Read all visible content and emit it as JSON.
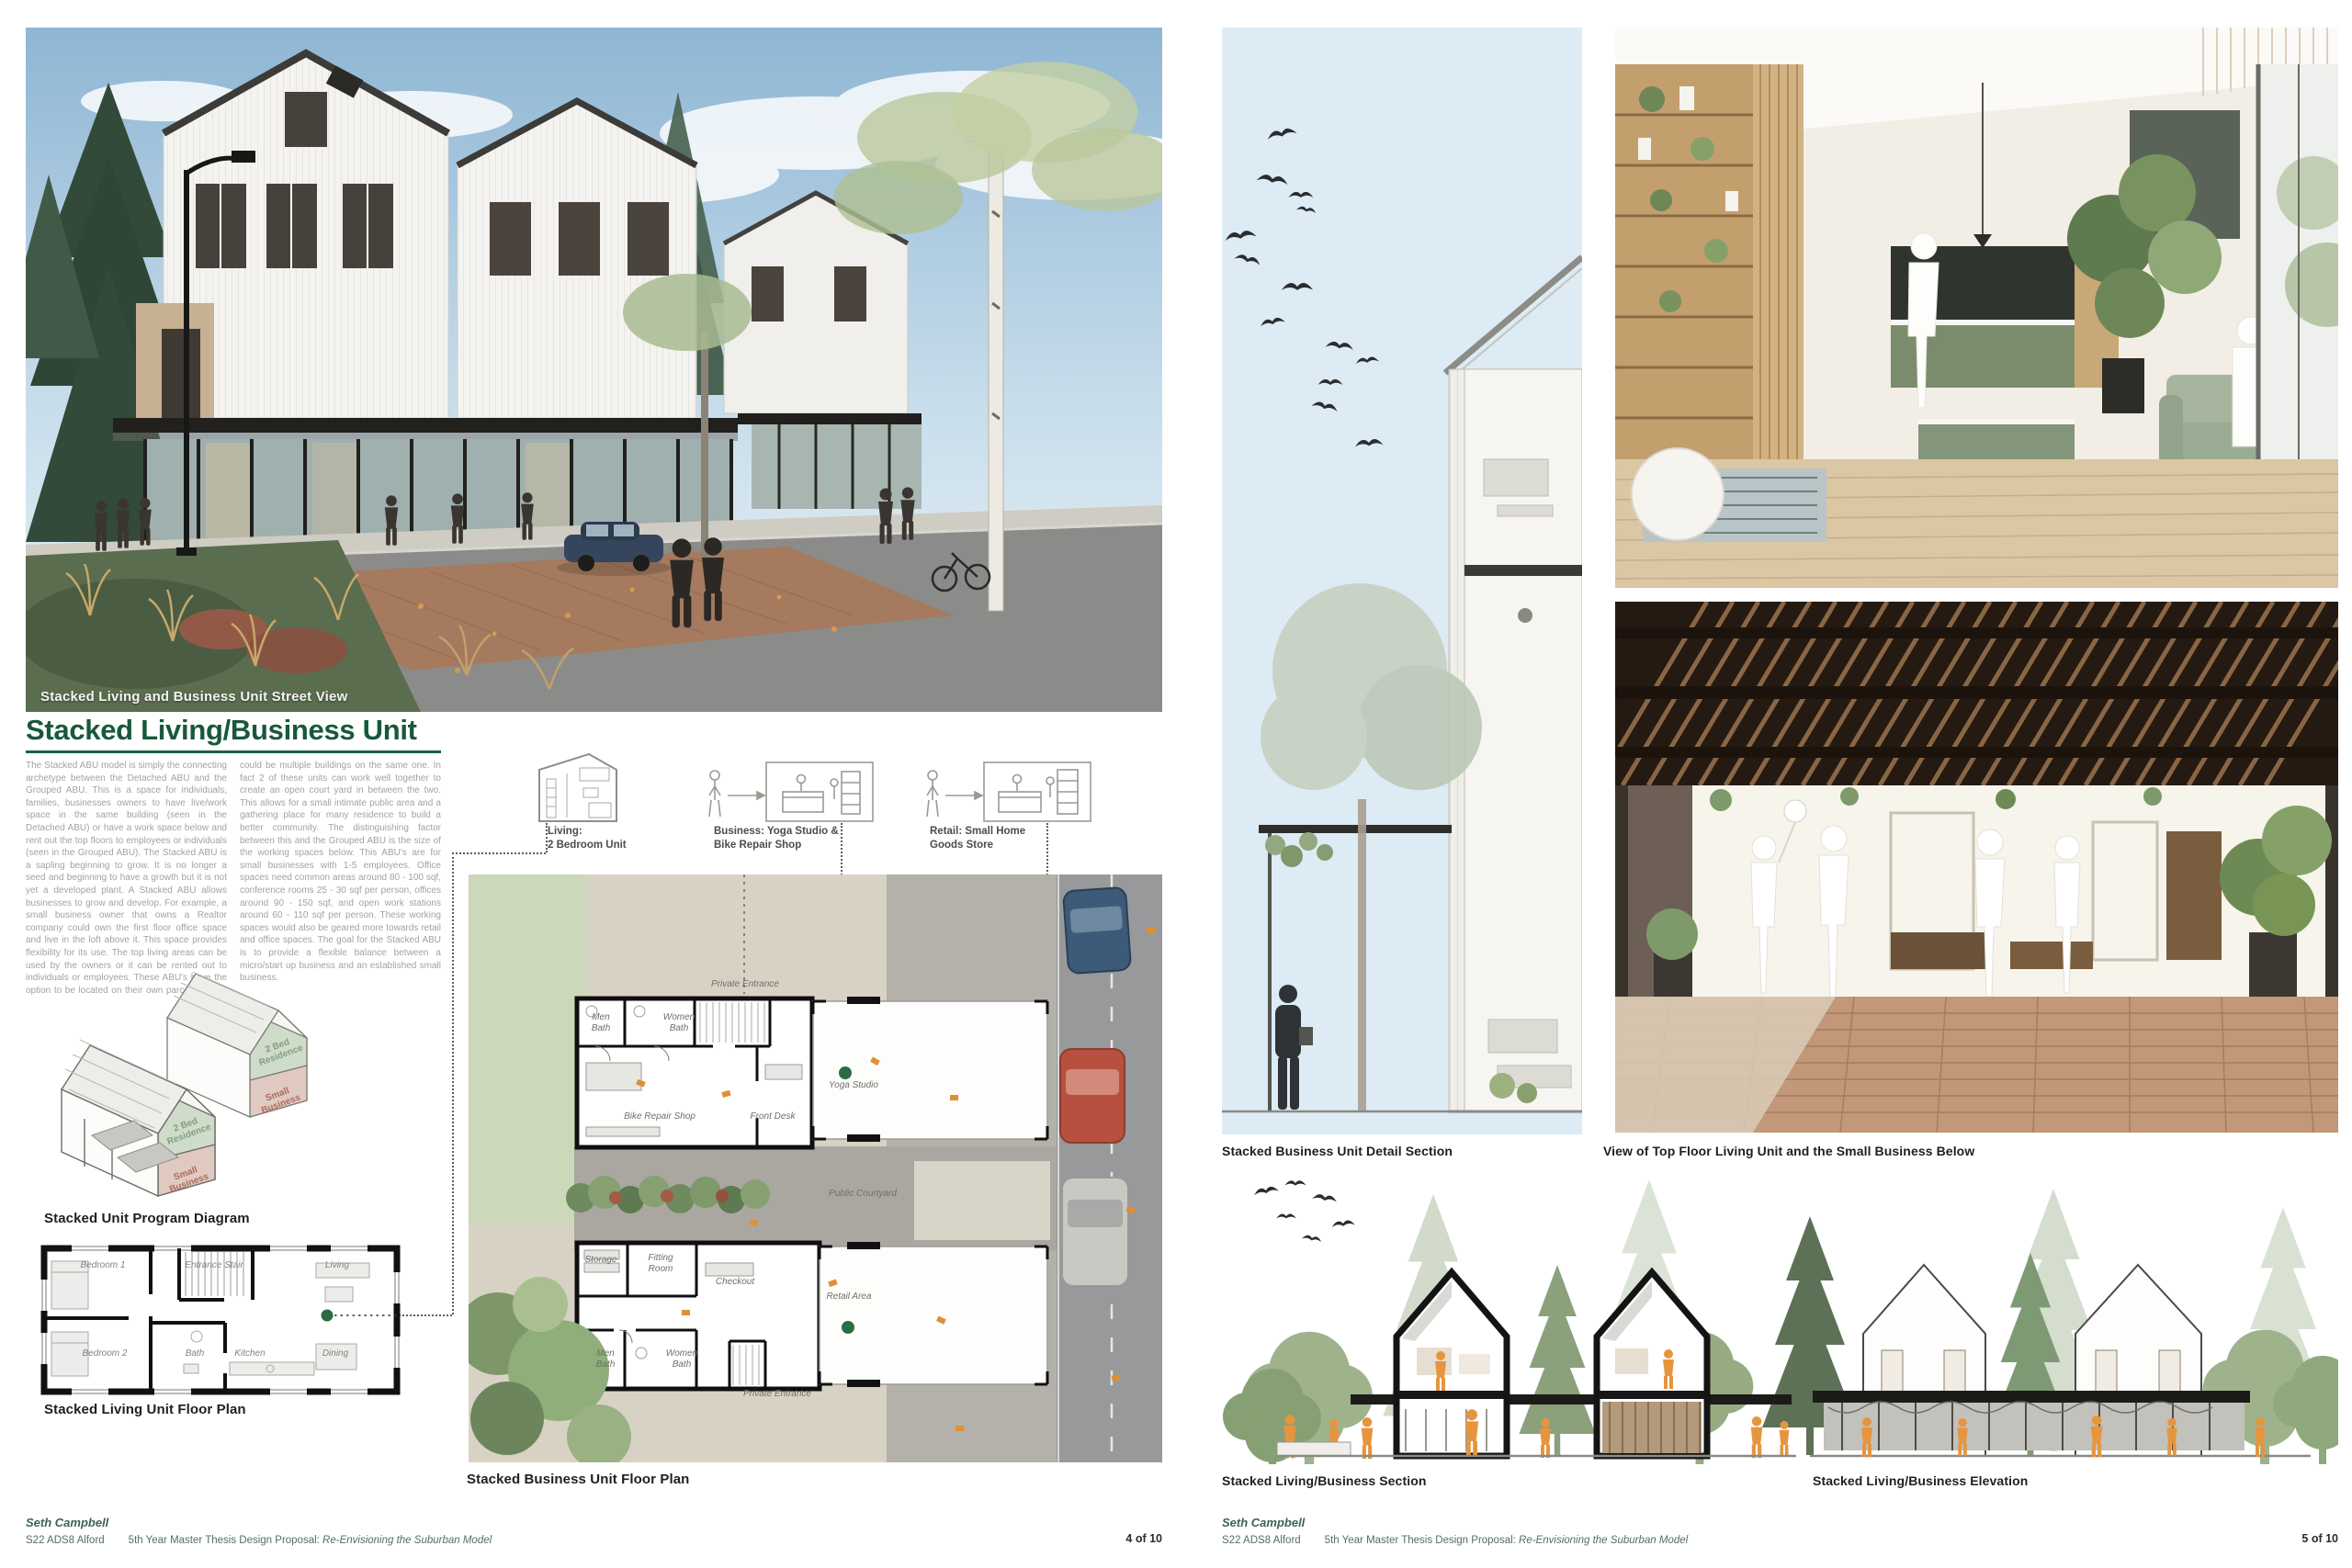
{
  "colors": {
    "title_green": "#17593a",
    "footer_green": "#3d6352",
    "accent_dot_green": "#2e6b45",
    "program_residence_green": "#7fa083",
    "program_business_red": "#ad6a5c",
    "body_text_gray": "#a2a2a0",
    "caption_black": "#1f1f1f",
    "figure_orange": "#e6953f",
    "section_sky_blue": "#dcebf4"
  },
  "page_left": {
    "street_view": {
      "caption": "Stacked Living and Business Unit Street View"
    },
    "title": "Stacked Living/Business Unit",
    "body": "The Stacked ABU model is simply the connecting archetype between the Detached ABU and the Grouped ABU. This is a space for individuals, families, businesses owners to have live/work space in the same building (seen in the Detached ABU) or have a work space below and rent out the top floors to employees or individuals (seen in the Grouped ABU). The Stacked ABU is a sapling beginning to grow. It is no longer a seed and beginning to have a growth but it is not yet a developed plant. A Stacked ABU allows businesses to grow and develop. For example, a small business owner that owns a Realtor company could own the first floor office space and live in the loft above it. This space provides flexibility for its use. The top living areas can be used by the owners or it can be rented out to individuals or employees. These ABU's have the option to be located on their own parcel or there could be multiple buildings on the same one. In fact 2 of these units can work well together to create an open court yard in between the two. This allows for a small intimate public area and a gathering place for many residence to build a better community. The distinguishing factor between this and the Grouped ABU is the size of the working spaces below. This ABU's are for small businesses with 1-5 employees. Office spaces need common areas around 80 - 100 sqf, conference rooms 25 - 30 sqf per person, offices around 90 - 150 sqf, and open work stations around 60 - 110 sqf per person. These working spaces would also be geared more towards retail and office spaces. The goal for the Stacked ABU is to provide a flexible balance between a micro/start up business and an established small business.",
    "unit_diagrams": {
      "living_l1": "Living:",
      "living_l2": "2 Bedroom Unit",
      "business_l1": "Business: Yoga Studio &",
      "business_l2": "Bike Repair Shop",
      "retail_l1": "Retail: Small Home",
      "retail_l2": "Goods Store"
    },
    "program_diagram": {
      "caption": "Stacked Unit Program Diagram",
      "residence_label": "2 Bed Residence",
      "business_label": "Small Business"
    },
    "living_plan": {
      "caption": "Stacked Living Unit Floor Plan",
      "rooms": {
        "bedroom1": "Bedroom 1",
        "entrance": "Entrance Stair",
        "living": "Living",
        "bedroom2": "Bedroom 2",
        "bath": "Bath",
        "kitchen": "Kitchen",
        "dining": "Dining"
      }
    },
    "business_plan": {
      "caption": "Stacked Business Unit Floor Plan",
      "labels": {
        "private_entrance_top": "Private Entrance",
        "men_bath_a": "Men Bath",
        "women_bath_a": "Women Bath",
        "bike_shop": "Bike Repair Shop",
        "front_desk": "Front Desk",
        "yoga_studio": "Yoga Studio",
        "public_courtyard": "Public Courtyard",
        "storage": "Storage",
        "fitting_room": "Fitting Room",
        "checkout": "Checkout",
        "retail_area": "Retail Area",
        "men_bath_b": "Men Bath",
        "women_bath_b": "Women Bath",
        "private_entrance_bottom": "Private Entrance"
      }
    },
    "footer": {
      "author": "Seth Campbell",
      "course": "S22 ADS8 Alford",
      "proposal_prefix": "5th Year Master Thesis Design Proposal: ",
      "proposal_title": "Re-Envisioning the Suburban Model",
      "page": "4 of 10"
    }
  },
  "page_right": {
    "captions": {
      "detail_section": "Stacked Business Unit Detail Section",
      "top_view": "View of Top Floor Living Unit and the Small Business Below",
      "section": "Stacked Living/Business Section",
      "elevation": "Stacked Living/Business Elevation"
    },
    "footer": {
      "author": "Seth Campbell",
      "course": "S22 ADS8 Alford",
      "proposal_prefix": "5th Year Master Thesis Design Proposal: ",
      "proposal_title": "Re-Envisioning the Suburban Model",
      "page": "5 of 10"
    }
  }
}
